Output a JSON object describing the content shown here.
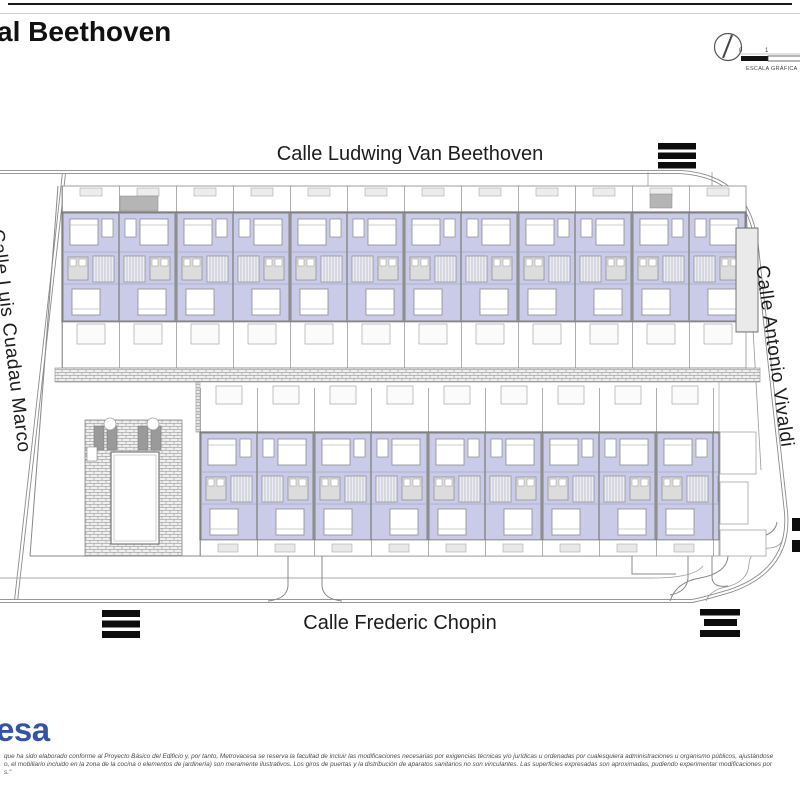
{
  "header": {
    "title": "al Beethoven",
    "scale": {
      "label": "ESCALA GRÁFICA",
      "tick_start": "0",
      "tick_mid": "1"
    }
  },
  "streets": {
    "north": "Calle Ludwing Van Beethoven",
    "south": "Calle Frederic Chopin",
    "west": "Calle Luis Cuadau Marco",
    "east": "Calle Antonio Vivaldi"
  },
  "plan": {
    "unit_fill_color": "#c9cbe9",
    "top_row_unit_count": 12,
    "bottom_row_unit_count": 9,
    "crosswalk_count": 4,
    "has_pool": true,
    "icons": {
      "north_arrow": "circle-with-needle",
      "crosswalk": "black-zebra-bars"
    }
  },
  "footer": {
    "logo_fragment": "esa",
    "logo_color": "#3354a5",
    "disclaimer_lines": [
      "que ha sido elaborado conforme al Proyecto Básico del Edificio y, por tanto, Metrovacesa se reserva la facultad de incluir las modificaciones necesarias por exigencias técnicas y/o jurídicas u ordenadas por cualesquiera administraciones u organismo públicos, ajustándose",
      "o, el mobiliario incluido en la zona de la cocina o elementos de jardinería) son meramente ilustrativos. Los giros de puertas y la distribución de aparatos sanitarios no son vinculantes. Las superficies expresadas son aproximadas, pudiendo experimentar modificaciones por",
      "s.\""
    ]
  }
}
